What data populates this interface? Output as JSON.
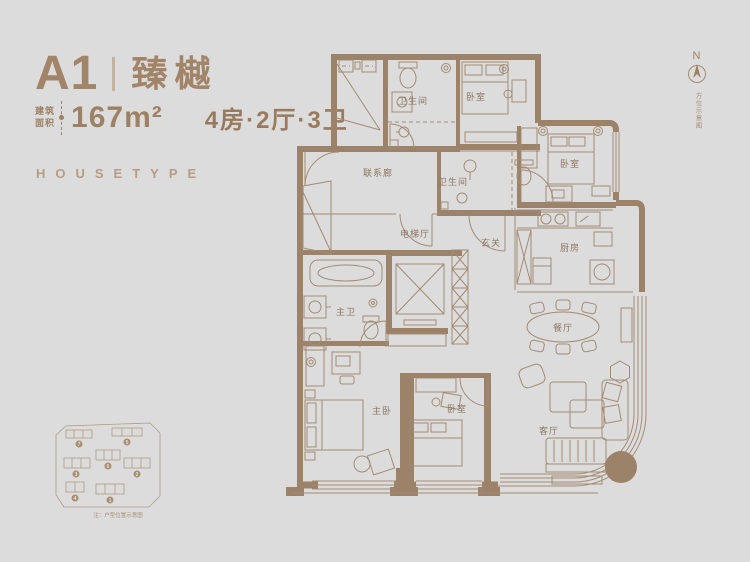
{
  "page": {
    "background": "#dcdcdc",
    "wall_color": "#9b8268",
    "line_color": "#a38b73",
    "accent_text": "#a28469"
  },
  "header": {
    "unit_code": "A1",
    "unit_name": "臻樾",
    "area_label_top": "建筑",
    "area_label_bottom": "面积",
    "area_value": "167m²",
    "layout_spec": "4房·2厅·3卫",
    "housetype_label": "HOUSETYPE"
  },
  "compass": {
    "north_label": "N",
    "note": "方位示意图"
  },
  "floorplan": {
    "rooms": [
      {
        "id": "bath-1",
        "label": "卫生间"
      },
      {
        "id": "bedroom-1",
        "label": "卧室"
      },
      {
        "id": "bedroom-2",
        "label": "卧室"
      },
      {
        "id": "corridor",
        "label": "联系廊"
      },
      {
        "id": "bath-2",
        "label": "卫生间"
      },
      {
        "id": "elevator-hall",
        "label": "电梯厅"
      },
      {
        "id": "foyer",
        "label": "玄关"
      },
      {
        "id": "kitchen",
        "label": "厨房"
      },
      {
        "id": "master-bath",
        "label": "主卫"
      },
      {
        "id": "dining",
        "label": "餐厅"
      },
      {
        "id": "master-bedroom",
        "label": "主卧"
      },
      {
        "id": "bedroom-3",
        "label": "卧室"
      },
      {
        "id": "living",
        "label": "客厅"
      }
    ]
  },
  "siteplan": {
    "caption": "注：户型位置示意图",
    "building_numbers": [
      "1",
      "2",
      "3",
      "4",
      "5",
      "6",
      "7"
    ]
  }
}
